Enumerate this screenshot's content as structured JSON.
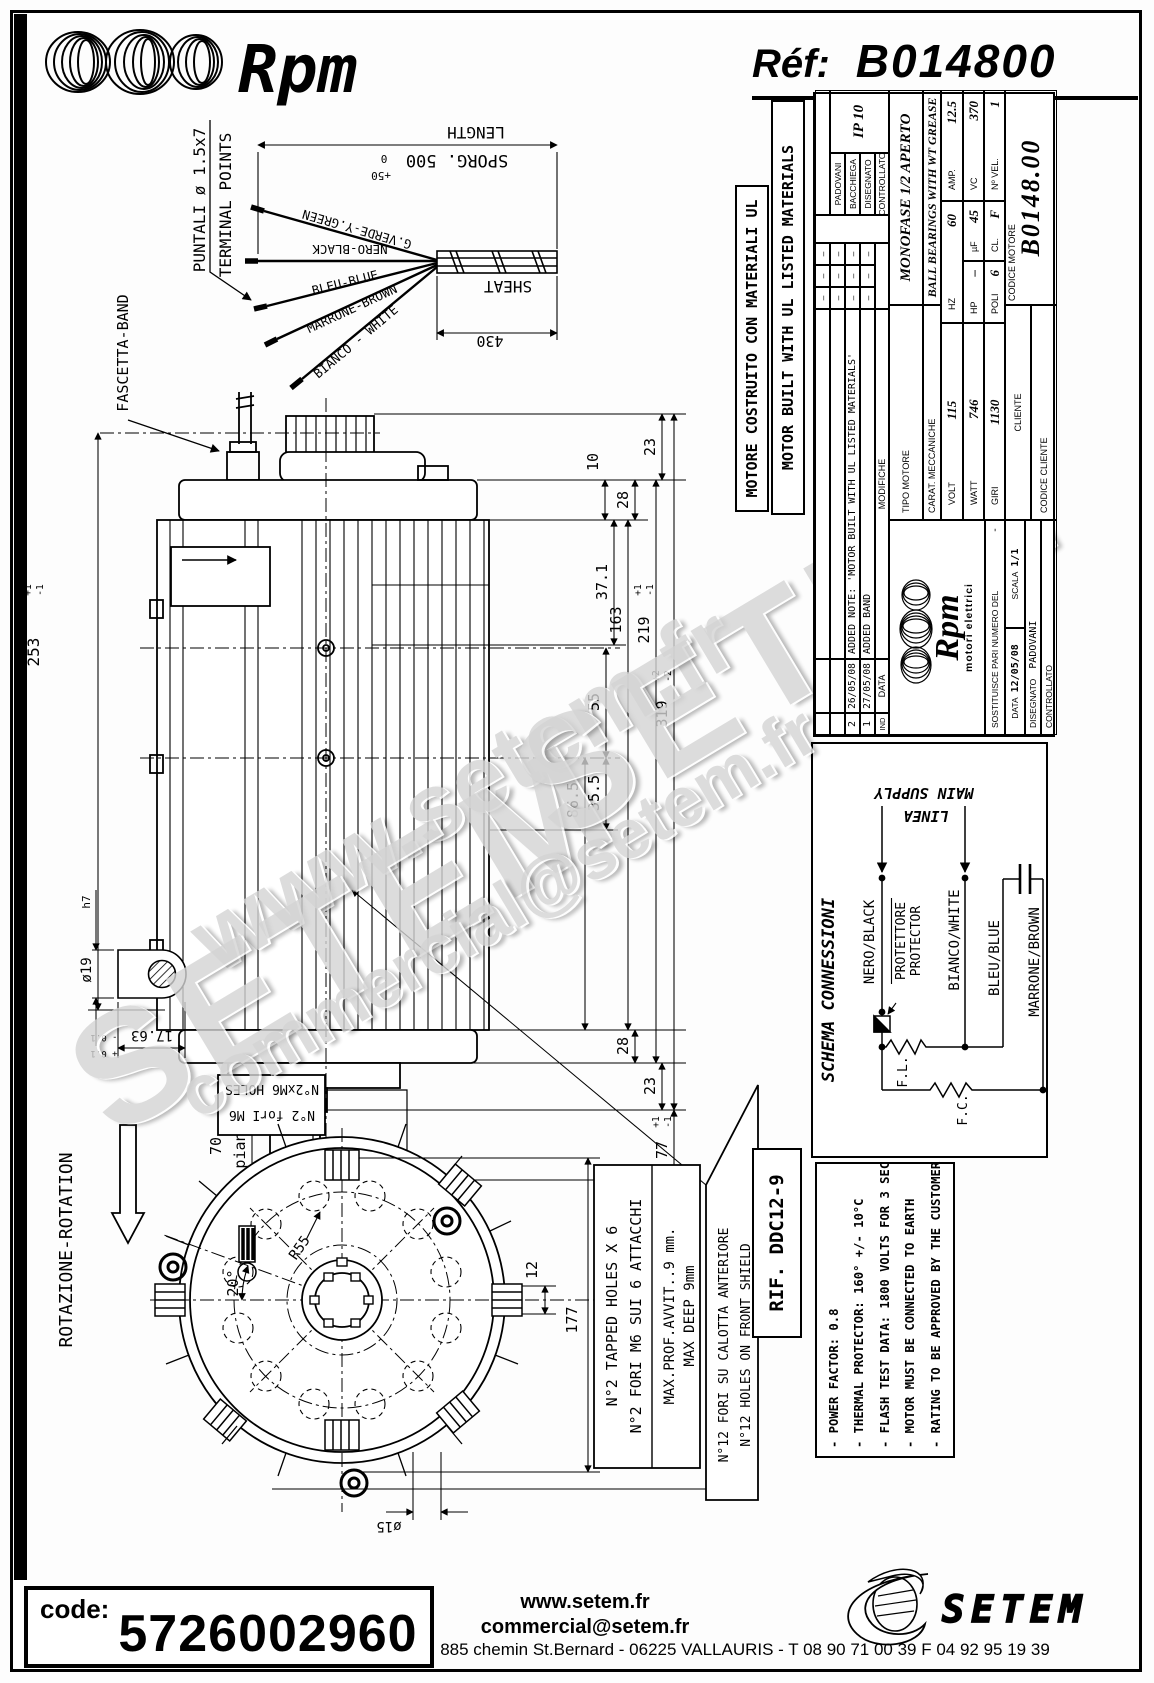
{
  "header": {
    "brand": "Rpm",
    "ref_label": "Réf:",
    "ref_value": "B014800"
  },
  "ul_boxes": {
    "it": "MOTORE COSTRUITO CON MATERIALI UL",
    "en": "MOTOR BUILT WITH UL LISTED MATERIALS"
  },
  "cable": {
    "puntali": "PUNTALI ø 1.5x7",
    "terminal": "TERMINAL POINTS",
    "fascetta": "FASCETTA-BAND",
    "length": "LENGTH",
    "sporg": "SPORG. 500",
    "sporg_zero": "0",
    "sporg_plus": "+50",
    "sheat": "SHEAT",
    "dim430": "430",
    "wires": [
      "G.VERDE-Y.GREEN",
      "NERO-BLACK",
      "BLEU-BLUE",
      "MARRONE-BROWN",
      "BIANCO - WHITE"
    ]
  },
  "side": {
    "d253": "253",
    "d253p": "+1",
    "d253m": "-1",
    "d23t": "23",
    "d28t": "28",
    "d10": "10",
    "d371": "37.1",
    "d163": "163",
    "d219": "219",
    "d219p": "+1",
    "d219m": "-1",
    "d55": "55",
    "d355": "35.5",
    "d865": "86.5",
    "d28b": "28",
    "d23b": "23",
    "d319": "319",
    "d319p": "+2",
    "d319m": "-2",
    "d77": "77",
    "d77p": "+1",
    "d77m": "-1",
    "d70": "70",
    "piano": "piano"
  },
  "shaft_detail": {
    "dia": "ø19",
    "h7": "h7",
    "d1763": "17.63",
    "tp": "+ 0.1",
    "tm": "- 0.1"
  },
  "holes_box": {
    "line1": "N°2 forI M6",
    "line2": "N°2xM6 HOLES"
  },
  "front": {
    "rotation": "ROTAZIONE-ROTATION",
    "angle": "20°",
    "r55": "R55",
    "d12": "12",
    "d177": "177",
    "d15": "ø15",
    "tapped1": "N°2 TAPPED HOLES X 6",
    "tapped2": "N°2 FORI M6 SUI 6 ATTACCHI",
    "max1": "MAX.PROF.AVVIT..9 mm.",
    "max2": "MAX DEEP 9mm",
    "n12_1": "N°12 FORI SU CALOTTA ANTERIORE",
    "n12_2": "N°12 HOLES ON FRONT SHIELD"
  },
  "title_block": {
    "h_ind": "IND",
    "h_data": "DATA",
    "h_mod": "MODIFICHE",
    "dash": "–",
    "mod_rows": [
      {
        "ind": "2",
        "date": "26/05/08",
        "text": "ADDED NOTE: 'MOTOR BUILT WITH UL LISTED MATERIALS'"
      },
      {
        "ind": "1",
        "date": "27/05/08",
        "text": "ADDED BAND"
      }
    ],
    "names": [
      "PADOVANI",
      "BACCHIEGA",
      "DISEGNATO",
      "CONTROLLATO"
    ],
    "ip": "IP 10",
    "tipo_label": "TIPO MOTORE",
    "tipo_value": "MONOFASE 1/2 APERTO",
    "carat_label": "CARAT. MECCANICHE",
    "carat_value": "BALL BEARINGS WITH WT GREASE",
    "volt_l": "VOLT",
    "volt_v": "115",
    "hz_l": "HZ",
    "hz_v": "60",
    "amp_l": "AMP.",
    "amp_v": "12.5",
    "watt_l": "WATT",
    "watt_v": "746",
    "hp_l": "HP",
    "hp_v": "–",
    "uf_l": "µF",
    "uf_v": "45",
    "vc_l": "VC",
    "vc_v": "370",
    "giri_l": "GIRI",
    "giri_v": "1130",
    "poli_l": "POLI",
    "poli_v": "6",
    "cl_l": "CL.",
    "cl_v": "F",
    "nvel_l": "Nº VEL.",
    "nvel_v": "1",
    "cliente": "CLIENTE",
    "codice_cliente": "CODICE CLIENTE",
    "codice_motore": "CODICE MOTORE",
    "codice_value": "B0148.00",
    "logo_text": "Rpm",
    "logo_sub": "motori elettrici",
    "sost": "SOSTITUISCE PARI NUMERO DEL",
    "sost_v": "-",
    "data_l": "DATA",
    "data_v": "12/05/08",
    "scala_l": "SCALA",
    "scala_v": "1/1",
    "disegnato_l": "DISEGNATO",
    "disegnato_v": "PADOVANI",
    "controllato_l": "CONTROLLATO"
  },
  "schema": {
    "title": "SCHEMA CONNESSIONI",
    "linea": "LINEA",
    "main": "MAIN SUPPLY",
    "w1": "NERO/BLACK",
    "w2": "BIANCO/WHITE",
    "w3": "BLEU/BLUE",
    "w4": "MARRONE/BROWN",
    "prot1": "PROTETTORE",
    "prot2": "PROTECTOR",
    "fl": "F.L.",
    "fc": "F.C."
  },
  "rif": "RIF. DDC12-9",
  "notes": [
    "- POWER FACTOR: 0.8",
    "- THERMAL PROTECTOR: 160° +/- 10°C",
    "- FLASH TEST DATA: 1800 VOLTS FOR 3 SEC",
    "- MOTOR MUST BE CONNECTED TO EARTH",
    "- RATING TO BE APPROVED BY THE CUSTOMER"
  ],
  "footer": {
    "code_label": "code:",
    "code_value": "5726002960",
    "site": "www.setem.fr",
    "email": "commercial@setem.fr",
    "address": "885 chemin St.Bernard  -  06225 VALLAURIS  -  T 08 90 71 00 39   F 04 92 95 19 39",
    "logo": "SETEM"
  },
  "watermarks": [
    "www.setem.fr",
    "SETEM",
    "SETEM",
    "commercial@setem.fr"
  ]
}
